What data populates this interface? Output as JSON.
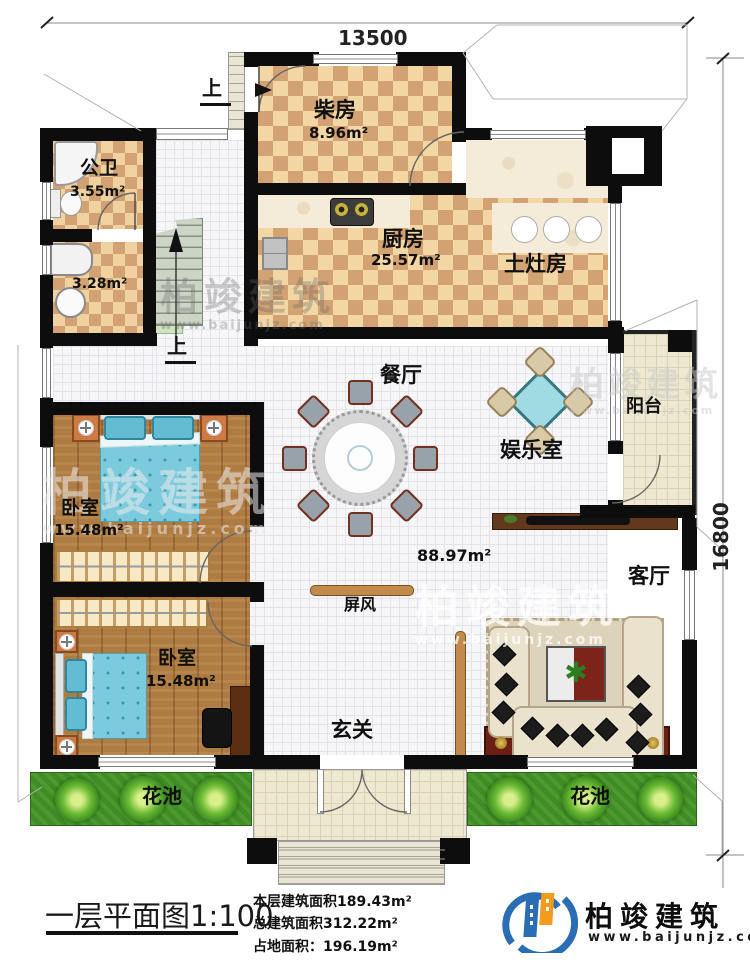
{
  "dimensions": {
    "top": "13500",
    "right": "16800"
  },
  "stairs": {
    "up_exterior": "上",
    "up_interior": "上"
  },
  "rooms": {
    "chaifang": {
      "name": "柴房",
      "area": "8.96m²"
    },
    "gongwei": {
      "name": "公卫",
      "area": "3.55m²"
    },
    "xiyi": {
      "area": "3.28m²"
    },
    "chufang": {
      "name": "厨房",
      "area": "25.57m²"
    },
    "tuzaofang": {
      "name": "土灶房"
    },
    "canting": {
      "name": "餐厅"
    },
    "yuleshi": {
      "name": "娱乐室"
    },
    "yangtai": {
      "name": "阳台"
    },
    "keting": {
      "name": "客厅"
    },
    "open_area": {
      "area": "88.97m²"
    },
    "pingfeng": {
      "name": "屏风"
    },
    "xuanguan": {
      "name": "玄关"
    },
    "bedroom1": {
      "name": "卧室",
      "area": "15.48m²"
    },
    "bedroom2": {
      "name": "卧室",
      "area": "15.48m²"
    },
    "huachi_left": {
      "name": "花池"
    },
    "huachi_right": {
      "name": "花池"
    }
  },
  "title_block": {
    "title": "一层平面图1:100",
    "floor_area": "本层建筑面积189.43m²",
    "total_area": "总建筑面积312.22m²",
    "land_area": "占地面积：196.19m²"
  },
  "brand": {
    "name": "柏竣建筑",
    "url": "www.baijunjz.com"
  },
  "watermark": {
    "name": "柏竣建筑",
    "url": "www.baijunjz.com"
  }
}
